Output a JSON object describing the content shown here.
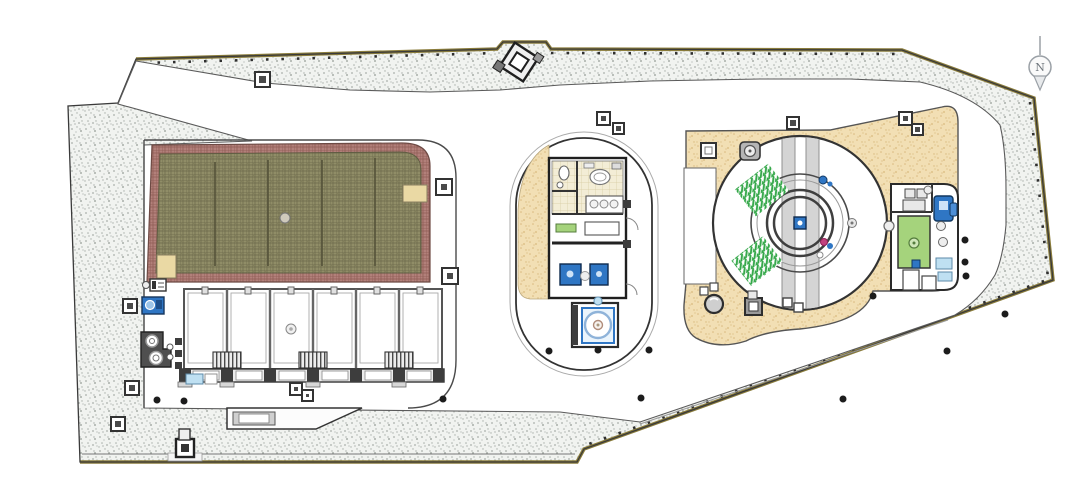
{
  "compass": {
    "label": "N"
  },
  "colors": {
    "background": "#ffffff",
    "outline_dark": "#3a3a3a",
    "curb_gray": "#555555",
    "perimeter_olive": "#8a7c3b",
    "stipple_base": "#f1f3f0",
    "stipple_dot": "#a9afaa",
    "tan_base": "#f2dfb4",
    "tan_dot": "#d9b97e",
    "bed_hatch_base": "#908d67",
    "bed_hatch_grid": "#6b684a",
    "bed_border_base": "#b2807a",
    "bed_border_grid": "#8f5c55",
    "beige_rect": "#ead9a4",
    "tile_base": "#f3edd6",
    "tile_grid": "#d6cba0",
    "green_stripe": "#35a84a",
    "room_green": "#a5d37c",
    "equipment_blue": "#2f76c4",
    "light_blue": "#bfe0f2",
    "walkway_gray": "#d4d4d4",
    "dot_black": "#1c1c1c",
    "compass_gray": "#9aa0a6"
  }
}
